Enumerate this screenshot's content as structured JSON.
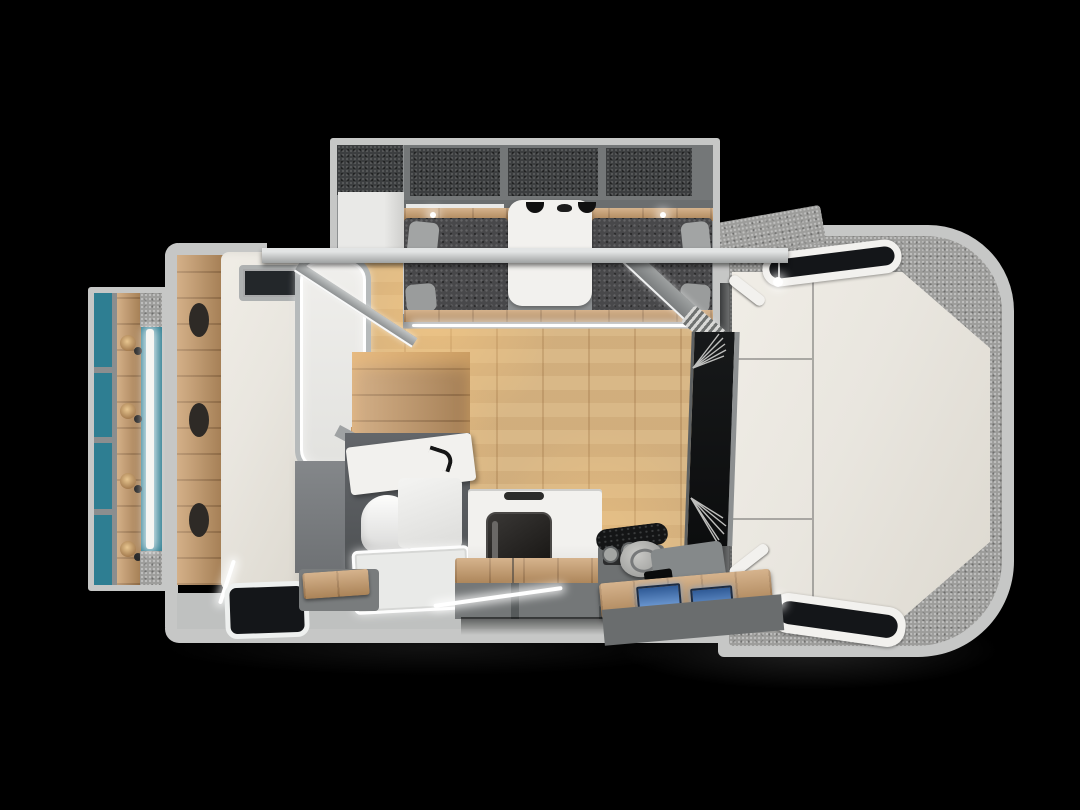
{
  "meta": {
    "description": "Top-down cutaway 3D render of a motorhome (campervan) interior floor plan on a black background; no text is visible in the image"
  },
  "palette": {
    "bg": "#000000",
    "shell": "#c6c7c6",
    "wall": "#a3a6a6",
    "panel": "#8e9192",
    "panel2": "#747778",
    "dark": "#55585a",
    "charcoal": "#3c3e3f",
    "uph": "#48484a",
    "carpet": "#9d9d9b",
    "carpetd": "#4a4c4d",
    "teal": "#2e7e92",
    "wood": "#c89a67",
    "woodd": "#a87848",
    "floor": "#d9b887",
    "floord": "#c6a06a",
    "cream": "#e9e6df",
    "white": "#f2f1ee",
    "white2": "#e9e9e7",
    "glass": "#141619",
    "blue": "#3c6cae",
    "blued": "#7ea6d8",
    "warm": "#ffc98a"
  },
  "scene": {
    "front_cab_section": [
      "outer-shell",
      "carpet-trim",
      "cab-over-mattress",
      "cab-window-top",
      "cab-window-bottom",
      "reading-lamps",
      "corner-trim-handles"
    ],
    "cockpit_console": [
      "windshield",
      "wipers",
      "defrost-vent",
      "steering-wheel",
      "cup-holders",
      "center-console",
      "dashboard-wood-shelf",
      "dashboard-screens"
    ],
    "dinette_slideout": [
      "overhead-shelves",
      "wardrobe",
      "light-rail",
      "bench-seats",
      "throw-pillows",
      "dinette-table",
      "pendant-lamps",
      "accent-led"
    ],
    "bedroom_slideout": [
      "open-shelf-column",
      "teal-accent-wall",
      "wood-headboard",
      "reading-sconces",
      "led-backlight"
    ],
    "main_cabin": [
      "wardrobe-column",
      "bed-mattress",
      "roof-vent",
      "led-framed-window",
      "wood-floor",
      "vanity-counter",
      "faucet",
      "bathroom-enclosure",
      "toilet",
      "shower-tray",
      "step-stool",
      "kitchen-cabinet",
      "oven",
      "bench-seat-wood",
      "storage-cabinet",
      "foot-window"
    ]
  }
}
